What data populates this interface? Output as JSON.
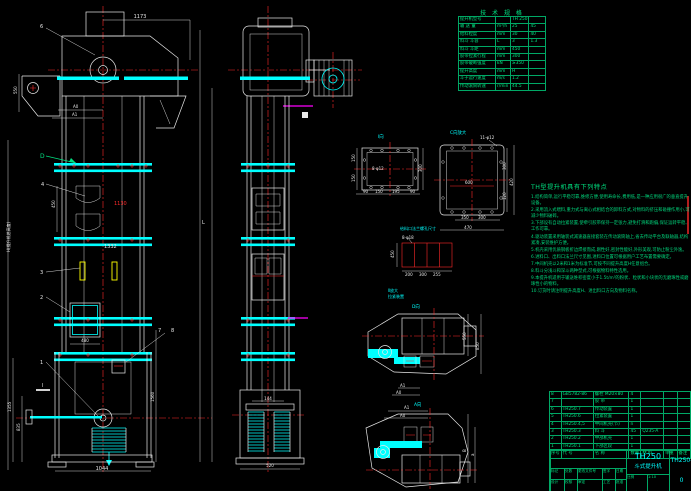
{
  "colors": {
    "bg": "#000000",
    "cyan": "#00ffff",
    "green": "#00e080",
    "red": "#ff2a2a",
    "white": "#e9e9e9",
    "magenta": "#ff00ff",
    "yellow": "#ffff00"
  },
  "specs": {
    "title": "技 术 规 格",
    "rows": [
      [
        "提升机型号",
        "",
        "TH 250",
        ""
      ],
      [
        "输 送 量",
        "m³/h",
        "25",
        "45"
      ],
      [
        "给料粒度",
        "mm",
        "30",
        "40"
      ],
      [
        "料斗 斗容",
        "L",
        "3",
        "1.3"
      ],
      [
        "料斗 斗距",
        "mm",
        "450",
        ""
      ],
      [
        "胶带拉紧行程",
        "mm",
        "300",
        ""
      ],
      [
        "胶带破断强度",
        "kN",
        "≥350",
        ""
      ],
      [
        "提升高度",
        "mm",
        "H",
        ""
      ],
      [
        "斗子运行速度",
        "m/s",
        "1.2",
        ""
      ],
      [
        "传动滚筒转速",
        "r/min",
        "44.5",
        ""
      ]
    ]
  },
  "features": {
    "title": "TH型提升机具有下列特点",
    "items": [
      "1.结构简单,运行平稳可靠,维修方便,使用寿命长,费用低,是一种应用很广的垂直提升设备。",
      "2.采用流入式喂料,重力式与离心式相结合的卸料方式,对物料的挤压和碰撞作用小,可减少物料破碎。",
      "3.下部设有自动拉紧装置,使牵引胶带保持一定张力,避免打滑和跑偏,保证运转平稳、工作可靠。",
      "4.驱动装置采用轴装式减速器直接套装在传动滚筒轴上,省去传动平台及联轴器,结构紧凑,安装维护方便。",
      "5.机壳采用优质钢板折边焊接而成,刚性好,密封性能好,外形美观,可防止粉尘外逸。",
      "6.进料口、出料口法兰尺寸见图,进料口位置可根据用户工艺布置需要确定。",
      "7.中间机壳以2米和1米为标准节,可按不同提升高度H任意组合。",
      "8.料斗分浅斗和深斗两种型式,可根据物料特性选用。",
      "9.本提升机适用于输送堆积密度小于1.5t/m³的粉状、粒状和小块状的无磨琢性或磨琢性小的物料。",
      "10.订货时请注明提升高度H、进出料口方向及物料名称。"
    ]
  },
  "bom": {
    "headers": [
      "序号",
      "代  号",
      "名  称",
      "数量",
      "材  料",
      "单重",
      "备注"
    ],
    "rows": [
      [
        "8",
        "GB5782-86",
        "螺栓 M20×80",
        "4",
        "",
        "",
        ""
      ],
      [
        "7",
        "",
        "胶  带",
        "1",
        "",
        "",
        ""
      ],
      [
        "6",
        "TH250.7",
        "传动装置",
        "1",
        "",
        "",
        ""
      ],
      [
        "5",
        "TH250.6",
        "拉紧装置",
        "1",
        "",
        "",
        ""
      ],
      [
        "4",
        "TH250.4,5",
        "中间机壳(节)",
        "n",
        "",
        "",
        ""
      ],
      [
        "3",
        "TH250.3",
        "料  斗",
        "45",
        "Q235-A",
        "",
        ""
      ],
      [
        "2",
        "TH250.2",
        "中部机壳",
        "1",
        "",
        "",
        ""
      ],
      [
        "1",
        "TH250.1",
        "下部区段",
        "1",
        "",
        "",
        ""
      ]
    ]
  },
  "title_block": {
    "model": "TH250",
    "product": "斗式提升机",
    "drawing_no": "TH250-0",
    "row1": [
      "标记",
      "处数",
      "更改文件号",
      "签字",
      "日期"
    ],
    "row2": [
      "设计",
      "校核",
      "审定",
      "工艺",
      "批准"
    ],
    "scale_label": "比例",
    "scale": "1:10"
  },
  "balloons": {
    "b6": "6",
    "bD": "D",
    "b4": "4",
    "b3": "3",
    "b2": "2",
    "b1": "1",
    "b7": "7",
    "b8": "8",
    "sec": "Ⅰ"
  },
  "labels": {
    "view1": "Ⅰ向",
    "view2": "C向放大",
    "dview": "D向",
    "aview": "A向",
    "holes1": "8-φ12",
    "holes2": "11-φ12",
    "holes3": "8-φ18",
    "detail_caption": "给料口法兰螺孔尺寸",
    "detail2a": "Ⅱ放大",
    "detail2b": "拉紧装置",
    "L": "L",
    "H": "H(提升机总高度)"
  },
  "dims": {
    "top1173": "1173",
    "a0": "A0",
    "a1": "A1",
    "head550": "550",
    "pitch450": "450",
    "mid1130": "1130",
    "mid1332": "1332",
    "door480": "480",
    "left1355": "1355",
    "left835": "835",
    "right1560": "1560",
    "base1044": "1044",
    "m144": "144",
    "m520": "520",
    "f1": [
      "90",
      "150",
      "195",
      "90"
    ],
    "f1s": [
      "150",
      "150"
    ],
    "f1r": "300",
    "f2": [
      "350",
      "300"
    ],
    "f2w": "470",
    "f2r": [
      "300",
      "120"
    ],
    "f2h": "420",
    "f2in": "600",
    "d450": "450",
    "d3": [
      "200",
      "300",
      "255"
    ],
    "dv": [
      "550",
      "850"
    ],
    "av": [
      "B",
      "a"
    ]
  }
}
